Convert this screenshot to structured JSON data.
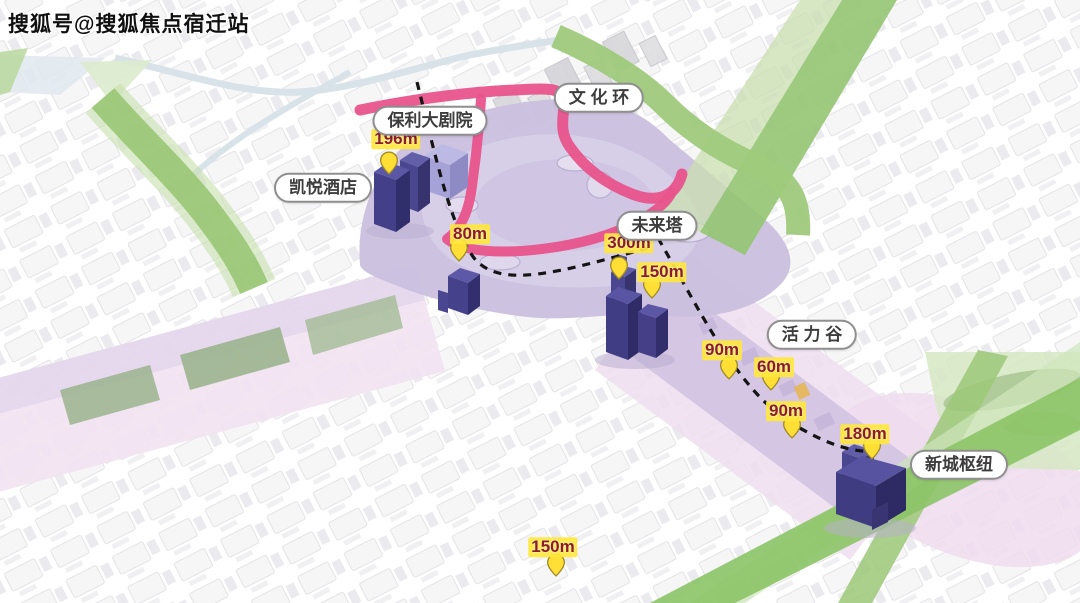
{
  "watermark": {
    "text": "搜狐号@搜狐焦点宿迁站"
  },
  "colors": {
    "ribbon_pink": "#e8548c",
    "park_lavender": "#cbc0df",
    "corridor_purple": "#d2c3e2",
    "axis_pink": "#f0def0",
    "green_band": "#94c571",
    "navy_building": "#413d85",
    "theater_periwinkle": "#a5a2d8",
    "pin_fill": "#ffdf35",
    "pin_stroke": "#a08b26",
    "height_text": "#8b1c2c",
    "height_chip_bg": "#ffe73e",
    "label_border": "#8f8f8f",
    "dashed_line": "#141414"
  },
  "map": {
    "zone_labels": [
      {
        "id": "poly-grand-theatre",
        "text": "保利大剧院",
        "x": 430,
        "y": 121
      },
      {
        "id": "hyatt-hotel",
        "text": "凯悦酒店",
        "x": 323,
        "y": 188
      },
      {
        "id": "culture-ring",
        "text": "文 化 环",
        "x": 599,
        "y": 98
      },
      {
        "id": "future-tower",
        "text": "未来塔",
        "x": 657,
        "y": 226
      },
      {
        "id": "vitality-valley",
        "text": "活 力 谷",
        "x": 812,
        "y": 335
      },
      {
        "id": "new-town-hub",
        "text": "新城枢纽",
        "x": 959,
        "y": 465
      }
    ],
    "height_markers": [
      {
        "label": "196m",
        "pin_x": 389,
        "pin_y": 176,
        "label_x": 396,
        "label_y": 139
      },
      {
        "label": "80m",
        "pin_x": 459,
        "pin_y": 263,
        "label_x": 470,
        "label_y": 234
      },
      {
        "label": "300m",
        "pin_x": 619,
        "pin_y": 281,
        "label_x": 629,
        "label_y": 243
      },
      {
        "label": "150m",
        "pin_x": 652,
        "pin_y": 300,
        "label_x": 662,
        "label_y": 272
      },
      {
        "label": "90m",
        "pin_x": 729,
        "pin_y": 381,
        "label_x": 722,
        "label_y": 350
      },
      {
        "label": "60m",
        "pin_x": 771,
        "pin_y": 392,
        "label_x": 774,
        "label_y": 367
      },
      {
        "label": "90m",
        "pin_x": 792,
        "pin_y": 440,
        "label_x": 786,
        "label_y": 411
      },
      {
        "label": "180m",
        "pin_x": 872,
        "pin_y": 461,
        "label_x": 865,
        "label_y": 434
      },
      {
        "label": "150m",
        "pin_x": 556,
        "pin_y": 578,
        "label_x": 553,
        "label_y": 547
      }
    ]
  }
}
